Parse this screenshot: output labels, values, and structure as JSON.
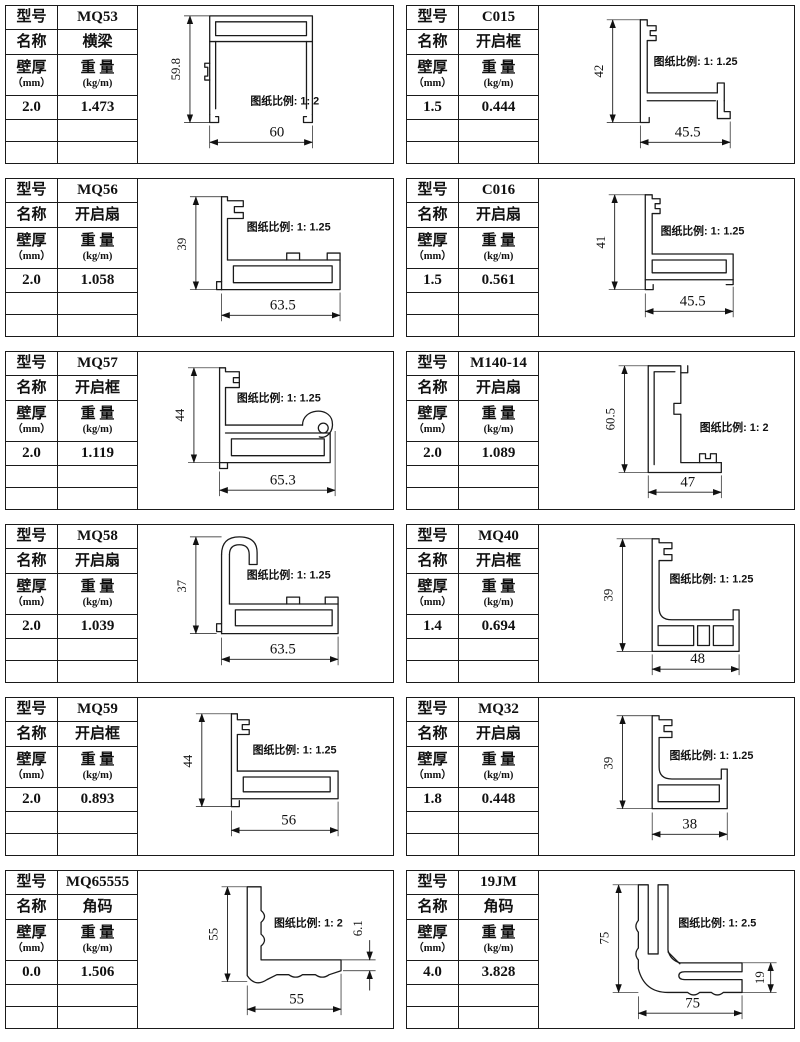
{
  "page": {
    "background": "#ffffff",
    "line_color": "#1a1a1a"
  },
  "labels": {
    "model": "型号",
    "name": "名称",
    "thickness": "壁厚",
    "thickness_unit": "（mm）",
    "weight": "重 量",
    "weight_unit": "(kg/m)"
  },
  "cells": [
    {
      "model": "MQ53",
      "name": "横梁",
      "thickness": "2.0",
      "weight": "1.473",
      "scale_note": "图纸比例: 1: 2",
      "dim_h": "59.8",
      "dim_w": "60"
    },
    {
      "model": "C015",
      "name": "开启框",
      "thickness": "1.5",
      "weight": "0.444",
      "scale_note": "图纸比例: 1: 1.25",
      "dim_h": "42",
      "dim_w": "45.5"
    },
    {
      "model": "MQ56",
      "name": "开启扇",
      "thickness": "2.0",
      "weight": "1.058",
      "scale_note": "图纸比例: 1: 1.25",
      "dim_h": "39",
      "dim_w": "63.5"
    },
    {
      "model": "C016",
      "name": "开启扇",
      "thickness": "1.5",
      "weight": "0.561",
      "scale_note": "图纸比例: 1: 1.25",
      "dim_h": "41",
      "dim_w": "45.5"
    },
    {
      "model": "MQ57",
      "name": "开启框",
      "thickness": "2.0",
      "weight": "1.119",
      "scale_note": "图纸比例: 1: 1.25",
      "dim_h": "44",
      "dim_w": "65.3"
    },
    {
      "model": "M140-14",
      "name": "开启扇",
      "thickness": "2.0",
      "weight": "1.089",
      "scale_note": "图纸比例: 1: 2",
      "dim_h": "60.5",
      "dim_w": "47"
    },
    {
      "model": "MQ58",
      "name": "开启扇",
      "thickness": "2.0",
      "weight": "1.039",
      "scale_note": "图纸比例: 1: 1.25",
      "dim_h": "37",
      "dim_w": "63.5"
    },
    {
      "model": "MQ40",
      "name": "开启框",
      "thickness": "1.4",
      "weight": "0.694",
      "scale_note": "图纸比例: 1: 1.25",
      "dim_h": "39",
      "dim_w": "48"
    },
    {
      "model": "MQ59",
      "name": "开启框",
      "thickness": "2.0",
      "weight": "0.893",
      "scale_note": "图纸比例: 1: 1.25",
      "dim_h": "44",
      "dim_w": "56"
    },
    {
      "model": "MQ32",
      "name": "开启扇",
      "thickness": "1.8",
      "weight": "0.448",
      "scale_note": "图纸比例: 1: 1.25",
      "dim_h": "39",
      "dim_w": "38"
    },
    {
      "model": "MQ65555",
      "name": "角码",
      "thickness": "0.0",
      "weight": "1.506",
      "scale_note": "图纸比例: 1: 2",
      "dim_h": "55",
      "dim_w": "55",
      "dim_extra": "6.1"
    },
    {
      "model": "19JM",
      "name": "角码",
      "thickness": "4.0",
      "weight": "3.828",
      "scale_note": "图纸比例: 1: 2.5",
      "dim_h": "75",
      "dim_w": "75",
      "dim_extra": "19"
    }
  ]
}
